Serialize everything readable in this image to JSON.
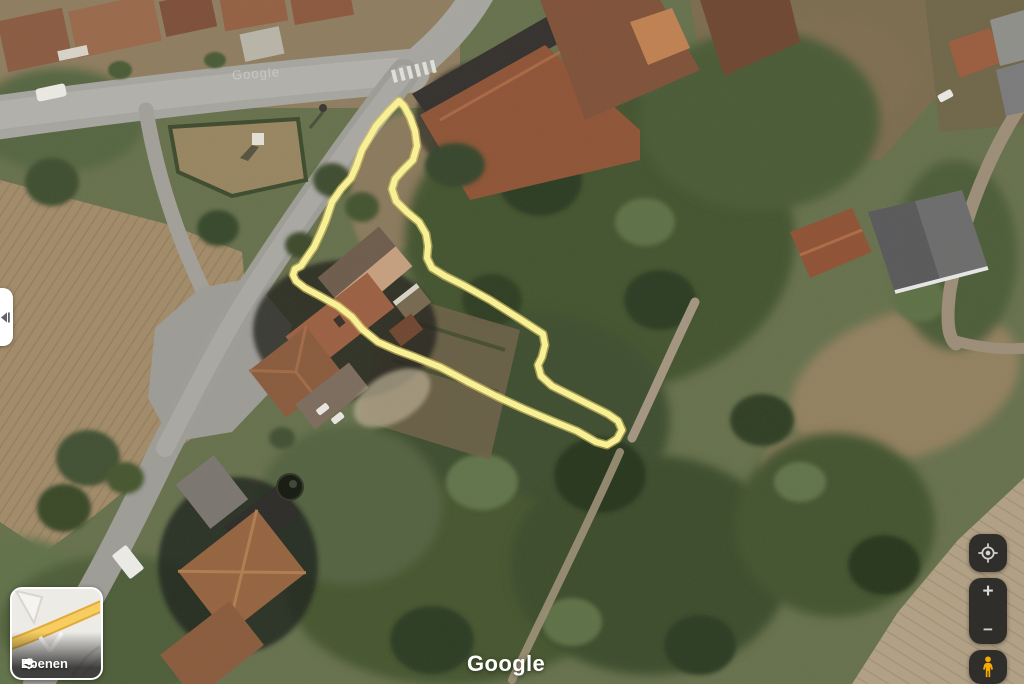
{
  "app": {
    "logo": "Google"
  },
  "map": {
    "view": "satellite",
    "faint_watermark": "Google",
    "selection_outline": {
      "color": "#f8f096",
      "edge_color": "#e3c95f",
      "path": "M399,101 L404,106 L410,117 L415,131 L417,146 L413,160 L403,170 L395,179 L392,189 L396,201 L407,212 L419,222 L426,234 L428,246 L427,258 L432,268 L445,276 L463,285 L490,300 L520,319 L543,334 L545,345 L542,357 L538,365 L541,376 L552,386 L570,395 L590,405 L608,414 L618,421 L622,430 L617,439 L607,445 L596,442 L577,431 L550,420 L524,409 L498,397 L470,383 L440,367 L415,357 L396,350 L378,342 L362,329 L352,317 L338,306 L320,296 L305,288 L296,281 L293,275 L295,269 L301,266 L307,257 L314,247 L321,232 L326,220 L332,202 L341,189 L351,178 L356,167 L362,150 L376,126 L389,111 Z"
    }
  },
  "controls": {
    "side_panel_toggle": {
      "icon": "collapse-arrow"
    },
    "layers": {
      "label": "Ebenen",
      "icon": "layers"
    },
    "my_location": {
      "icon": "crosshair-target"
    },
    "zoom": {
      "in_label": "+",
      "out_label": "−"
    },
    "street_view": {
      "icon": "pegman",
      "color": "#f9ab00"
    }
  }
}
